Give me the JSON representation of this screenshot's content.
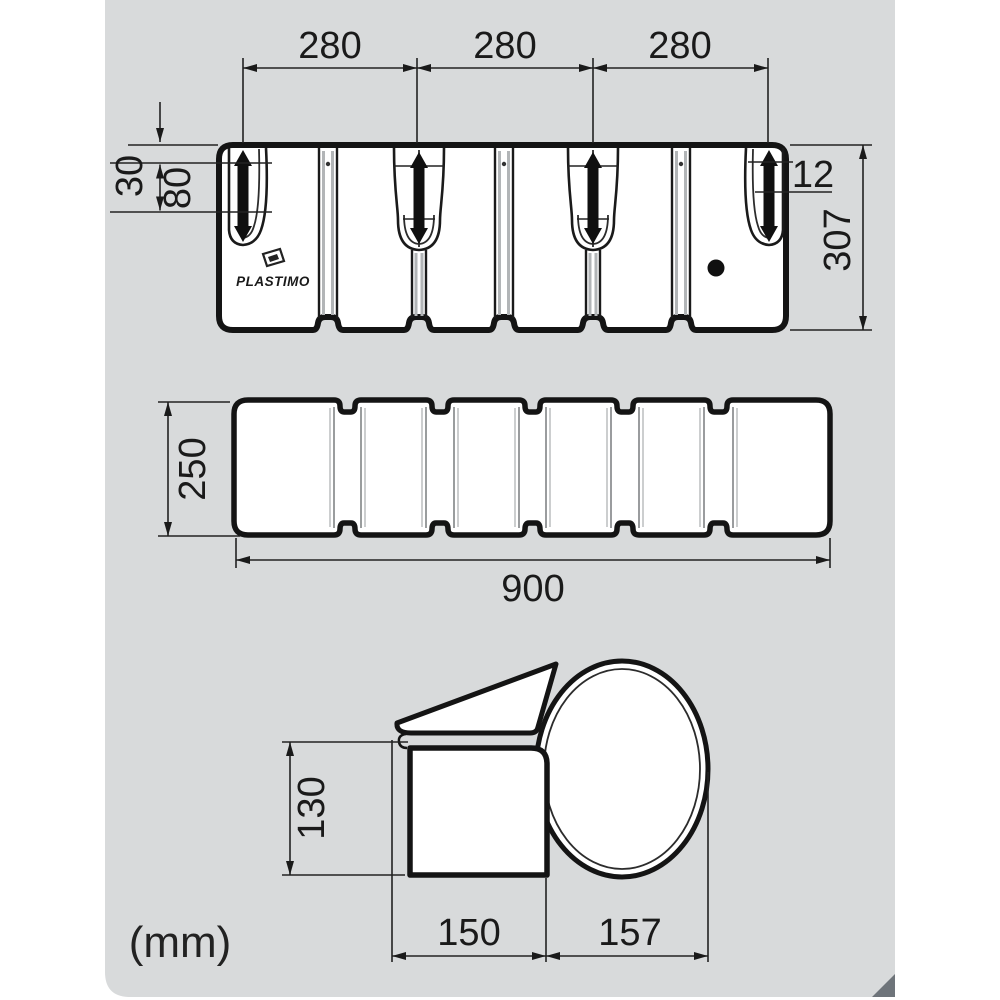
{
  "drawing": {
    "brand_label": "PLASTIMO",
    "units_label": "(mm)",
    "front_view": {
      "pitch_dim_1": "280",
      "pitch_dim_2": "280",
      "pitch_dim_3": "280",
      "top_offset_dim": "30",
      "handle_slot_dim": "80",
      "slot_width_dim": "12",
      "height_dim": "307"
    },
    "top_view": {
      "depth_dim": "250",
      "length_dim": "900"
    },
    "side_view": {
      "height_dim": "130",
      "flange_width_dim": "150",
      "bumper_width_dim": "157"
    },
    "colors": {
      "panel_bg": "#d8dadb",
      "outline": "#141414",
      "dim_line": "#222222",
      "fill_white": "#ffffff",
      "shade_gray": "#b2b5b7",
      "black_detail": "#101010",
      "fold_corner": "#6e747a"
    }
  }
}
